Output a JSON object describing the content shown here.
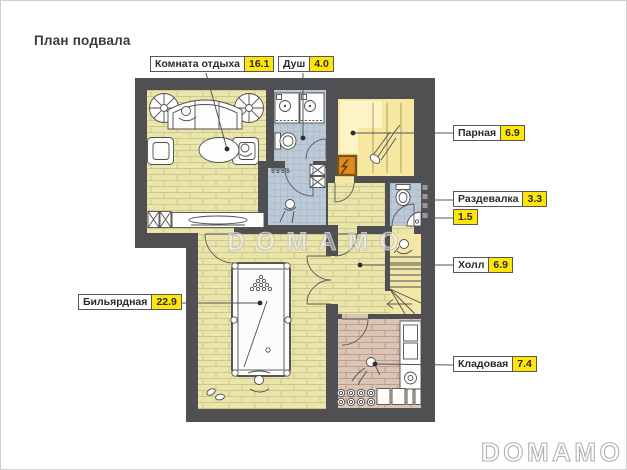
{
  "page": {
    "title": "План подвала",
    "watermark": "DOMAMO",
    "logo": "DOMAMO"
  },
  "labels": [
    {
      "id": "rest",
      "name": "Комната отдыха",
      "area": "16.1"
    },
    {
      "id": "shower",
      "name": "Душ",
      "area": "4.0"
    },
    {
      "id": "steam",
      "name": "Парная",
      "area": "6.9"
    },
    {
      "id": "dressing",
      "name": "Раздевалка",
      "area": "3.3"
    },
    {
      "id": "wc",
      "area": "1.5"
    },
    {
      "id": "hall",
      "name": "Холл",
      "area": "6.9"
    },
    {
      "id": "billiard",
      "name": "Бильярдная",
      "area": "22.9"
    },
    {
      "id": "storage",
      "name": "Кладовая",
      "area": "7.4"
    }
  ],
  "colors": {
    "wall": "#505053",
    "wood": "#eae5ab",
    "wood_line": "#c6bf85",
    "tile": "#bccad7",
    "tile_line": "#a7b9c8",
    "steam": "#f6e8a0",
    "steam_bench": "#fcf3c6",
    "stairs": "#f3e7a8",
    "storage_floor": "#dac4b4",
    "storage_line": "#b3917e",
    "stove": "#e5891e",
    "label_value_bg": "#ffe608",
    "line": "#55555a",
    "watermark": "#c6c6c6"
  }
}
